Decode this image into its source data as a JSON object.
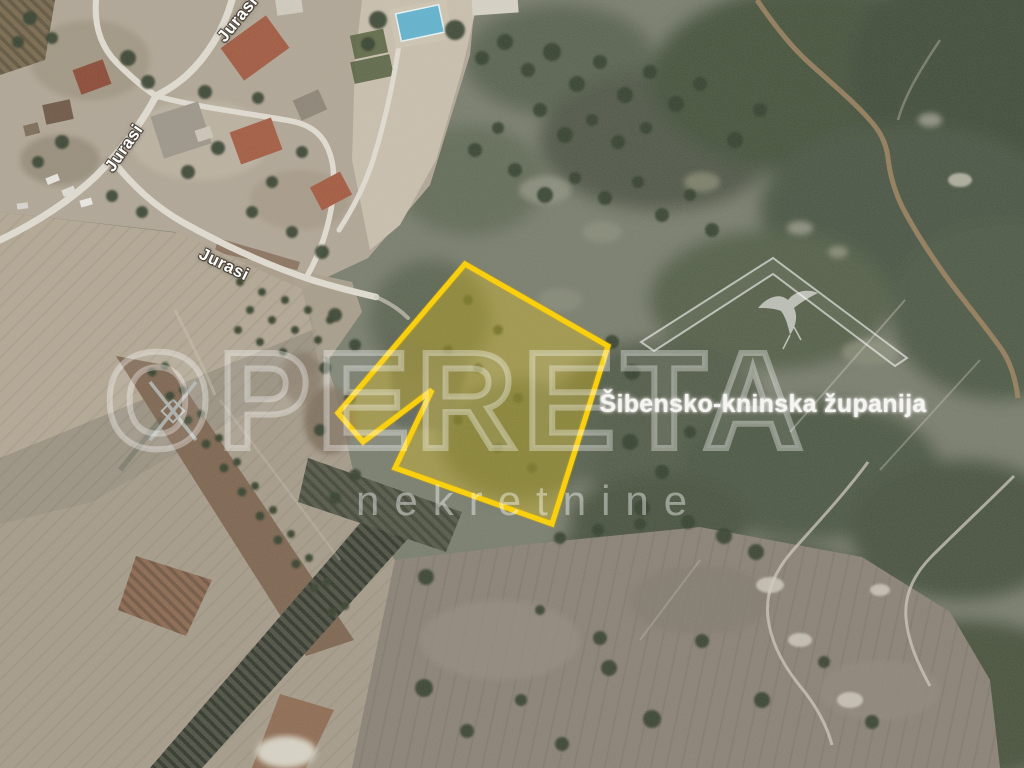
{
  "map": {
    "street_labels": [
      {
        "id": "north",
        "text": "Jurasi"
      },
      {
        "id": "west",
        "text": "Jurasi"
      },
      {
        "id": "center",
        "text": "Jurasi"
      }
    ]
  },
  "watermark": {
    "brand": "OPERETA",
    "subtitle": "nekretnine"
  },
  "region_overlay": {
    "label": "Šibensko-kninska županija",
    "icon": "roof-swallow-logo"
  },
  "colors": {
    "parcel_outline": "#ffd200",
    "parcel_fill": "rgba(255,211,0,0.30)",
    "watermark_stroke": "rgba(255,255,255,0.34)",
    "watermark_fill": "rgba(255,255,255,0.07)",
    "subtitle_color": "rgba(255,255,255,0.42)",
    "street_label_fill": "#ffffff",
    "region_label_color": "#f6f5f1",
    "logo_color": "rgba(246,246,243,0.62)",
    "pool_water": "#62b4cf"
  }
}
